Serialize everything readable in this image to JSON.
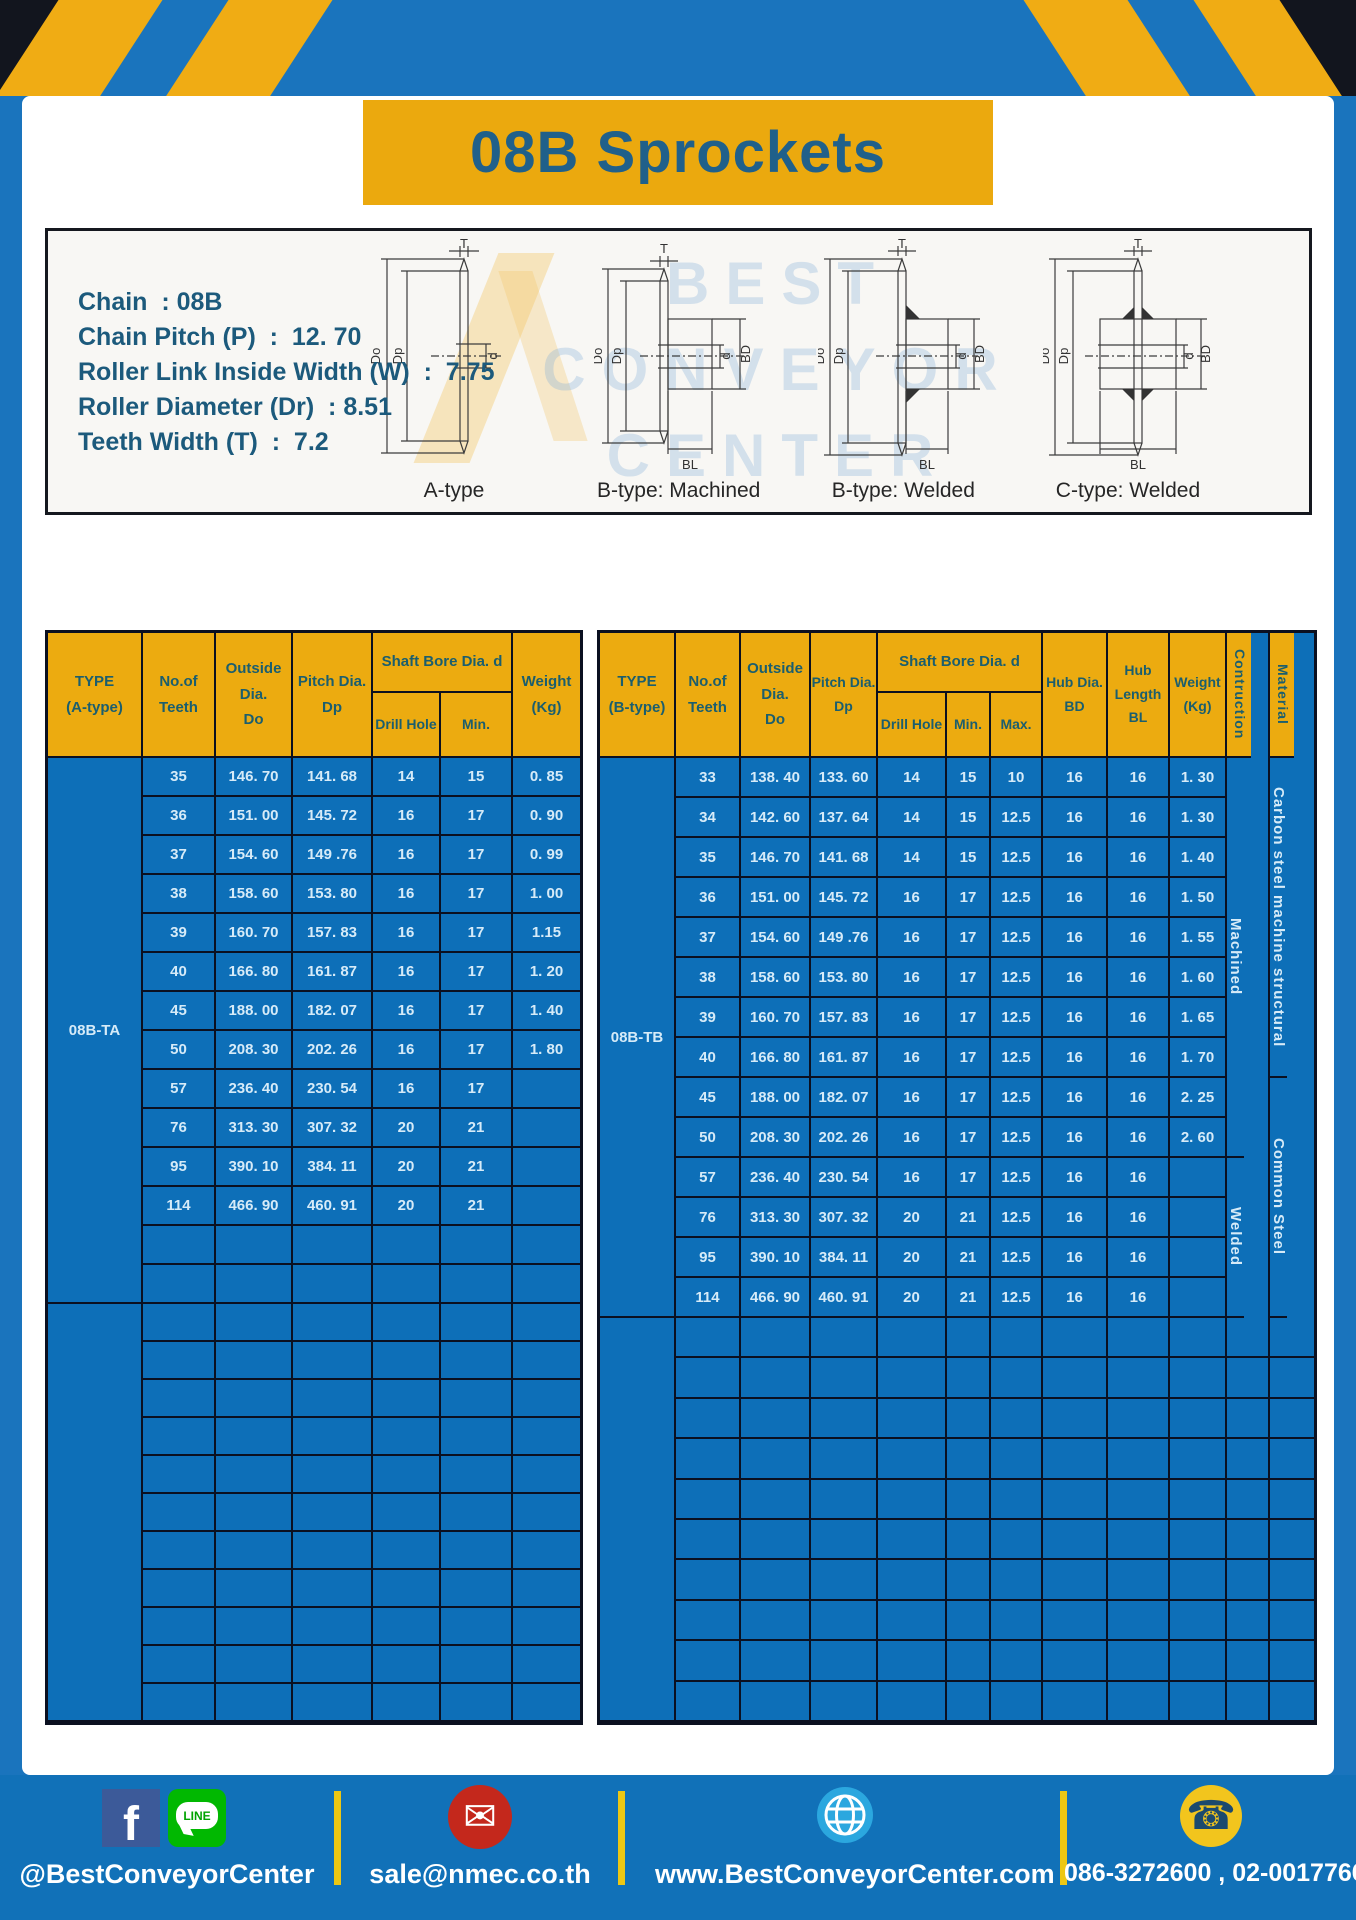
{
  "title": "08B Sprockets",
  "specs": [
    "Chain  : 08B",
    "Chain Pitch (P)  :  12. 70",
    "Roller Link Inside Width (W)  :  7.75",
    "Roller Diameter (Dr)  : 8.51",
    "Teeth Width (T)  :  7.2"
  ],
  "watermark": [
    "BEST",
    "CONVEYOR",
    "CENTER"
  ],
  "diagram": {
    "labels": [
      "A-type",
      "B-type: Machined",
      "B-type: Welded",
      "C-type: Welded"
    ],
    "dims": {
      "t": "T",
      "do": "Do",
      "dp": "Dp",
      "d": "d",
      "bd": "BD",
      "bl": "BL"
    }
  },
  "left_table": {
    "header": {
      "type": "TYPE\n(A-type)",
      "teeth": "No.of\nTeeth",
      "outside": "Outside\nDia.\nDo",
      "pitch": "Pitch Dia.\nDp",
      "shaft_bore": "Shaft Bore Dia. d",
      "drill": "Drill Hole",
      "min": "Min.",
      "weight": "Weight\n(Kg)"
    },
    "type_label": "08B-TA",
    "rows": [
      {
        "teeth": "35",
        "outside": "146. 70",
        "pitch": "141. 68",
        "drill": "14",
        "min": "15",
        "weight": "0. 85"
      },
      {
        "teeth": "36",
        "outside": "151. 00",
        "pitch": "145. 72",
        "drill": "16",
        "min": "17",
        "weight": "0. 90"
      },
      {
        "teeth": "37",
        "outside": "154. 60",
        "pitch": "149 .76",
        "drill": "16",
        "min": "17",
        "weight": "0. 99"
      },
      {
        "teeth": "38",
        "outside": "158. 60",
        "pitch": "153. 80",
        "drill": "16",
        "min": "17",
        "weight": "1. 00"
      },
      {
        "teeth": "39",
        "outside": "160. 70",
        "pitch": "157. 83",
        "drill": "16",
        "min": "17",
        "weight": "1.15"
      },
      {
        "teeth": "40",
        "outside": "166. 80",
        "pitch": "161. 87",
        "drill": "16",
        "min": "17",
        "weight": "1. 20"
      },
      {
        "teeth": "45",
        "outside": "188. 00",
        "pitch": "182. 07",
        "drill": "16",
        "min": "17",
        "weight": "1. 40"
      },
      {
        "teeth": "50",
        "outside": "208. 30",
        "pitch": "202. 26",
        "drill": "16",
        "min": "17",
        "weight": "1. 80"
      },
      {
        "teeth": "57",
        "outside": "236. 40",
        "pitch": "230. 54",
        "drill": "16",
        "min": "17",
        "weight": ""
      },
      {
        "teeth": "76",
        "outside": "313. 30",
        "pitch": "307. 32",
        "drill": "20",
        "min": "21",
        "weight": ""
      },
      {
        "teeth": "95",
        "outside": "390. 10",
        "pitch": "384. 11",
        "drill": "20",
        "min": "21",
        "weight": ""
      },
      {
        "teeth": "114",
        "outside": "466. 90",
        "pitch": "460. 91",
        "drill": "20",
        "min": "21",
        "weight": ""
      }
    ]
  },
  "right_table": {
    "header": {
      "type": "TYPE\n(B-type)",
      "teeth": "No.of\nTeeth",
      "outside": "Outside\nDia.\nDo",
      "pitch": "Pitch Dia.\nDp",
      "shaft_bore": "Shaft Bore Dia. d",
      "drill": "Drill Hole",
      "min": "Min.",
      "max": "Max.",
      "hub_dia": "Hub Dia.\nBD",
      "hub_len": "Hub\nLength\nBL",
      "weight": "Weight\n(Kg)",
      "construction": "Contruction",
      "material": "Material"
    },
    "type_label": "08B-TB",
    "rows": [
      {
        "teeth": "33",
        "outside": "138. 40",
        "pitch": "133. 60",
        "drill": "14",
        "min": "15",
        "max": "10",
        "bd": "16",
        "bl": "16",
        "weight": "1. 30"
      },
      {
        "teeth": "34",
        "outside": "142. 60",
        "pitch": "137. 64",
        "drill": "14",
        "min": "15",
        "max": "12.5",
        "bd": "16",
        "bl": "16",
        "weight": "1. 30"
      },
      {
        "teeth": "35",
        "outside": "146. 70",
        "pitch": "141. 68",
        "drill": "14",
        "min": "15",
        "max": "12.5",
        "bd": "16",
        "bl": "16",
        "weight": "1. 40"
      },
      {
        "teeth": "36",
        "outside": "151. 00",
        "pitch": "145. 72",
        "drill": "16",
        "min": "17",
        "max": "12.5",
        "bd": "16",
        "bl": "16",
        "weight": "1. 50"
      },
      {
        "teeth": "37",
        "outside": "154. 60",
        "pitch": "149 .76",
        "drill": "16",
        "min": "17",
        "max": "12.5",
        "bd": "16",
        "bl": "16",
        "weight": "1. 55"
      },
      {
        "teeth": "38",
        "outside": "158. 60",
        "pitch": "153. 80",
        "drill": "16",
        "min": "17",
        "max": "12.5",
        "bd": "16",
        "bl": "16",
        "weight": "1. 60"
      },
      {
        "teeth": "39",
        "outside": "160. 70",
        "pitch": "157. 83",
        "drill": "16",
        "min": "17",
        "max": "12.5",
        "bd": "16",
        "bl": "16",
        "weight": "1. 65"
      },
      {
        "teeth": "40",
        "outside": "166. 80",
        "pitch": "161. 87",
        "drill": "16",
        "min": "17",
        "max": "12.5",
        "bd": "16",
        "bl": "16",
        "weight": "1. 70"
      },
      {
        "teeth": "45",
        "outside": "188. 00",
        "pitch": "182. 07",
        "drill": "16",
        "min": "17",
        "max": "12.5",
        "bd": "16",
        "bl": "16",
        "weight": "2. 25"
      },
      {
        "teeth": "50",
        "outside": "208. 30",
        "pitch": "202. 26",
        "drill": "16",
        "min": "17",
        "max": "12.5",
        "bd": "16",
        "bl": "16",
        "weight": "2. 60"
      },
      {
        "teeth": "57",
        "outside": "236. 40",
        "pitch": "230. 54",
        "drill": "16",
        "min": "17",
        "max": "12.5",
        "bd": "16",
        "bl": "16",
        "weight": ""
      },
      {
        "teeth": "76",
        "outside": "313. 30",
        "pitch": "307. 32",
        "drill": "20",
        "min": "21",
        "max": "12.5",
        "bd": "16",
        "bl": "16",
        "weight": ""
      },
      {
        "teeth": "95",
        "outside": "390. 10",
        "pitch": "384. 11",
        "drill": "20",
        "min": "21",
        "max": "12.5",
        "bd": "16",
        "bl": "16",
        "weight": ""
      },
      {
        "teeth": "114",
        "outside": "466. 90",
        "pitch": "460. 91",
        "drill": "20",
        "min": "21",
        "max": "12.5",
        "bd": "16",
        "bl": "16",
        "weight": ""
      }
    ],
    "construction_groups": [
      {
        "label": "Machined"
      },
      {
        "label": "Welded"
      }
    ],
    "material_groups": [
      {
        "label": "Carbon steel  machine structural"
      },
      {
        "label": "Common Steel"
      }
    ]
  },
  "footer": {
    "facebook_label": "f",
    "line_label": "LINE",
    "social": "@BestConveyorCenter",
    "email": "sale@nmec.co.th",
    "website": "www.BestConveyorCenter.com",
    "phone": "086-3272600 , 02-0017766"
  },
  "colors": {
    "frame_blue": "#1a74bd",
    "table_blue": "#0d6fb8",
    "accent_yellow": "#ecab10",
    "header_text": "#1b5e6e",
    "title_text": "#20608a",
    "border_dark": "#0b1020"
  }
}
